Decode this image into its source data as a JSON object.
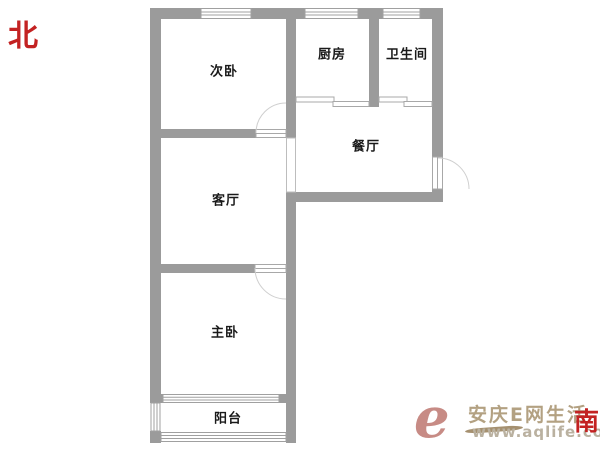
{
  "compass": {
    "north": "北",
    "south": "南",
    "color": "#c32222"
  },
  "rooms": [
    {
      "name": "次卧"
    },
    {
      "name": "厨房"
    },
    {
      "name": "卫生间"
    },
    {
      "name": "餐厅"
    },
    {
      "name": "客厅"
    },
    {
      "name": "主卧"
    },
    {
      "name": "阳台"
    }
  ],
  "watermark": {
    "logo": "e",
    "site_name": "安庆E网生活",
    "url": "www.aqlife.com",
    "logo_color": "#c78b85",
    "site_name_color": "#b3a182",
    "url_color": "#bab1a0"
  },
  "colors": {
    "wall": "#9b9b9b",
    "window_outline": "#a0a0a0",
    "door_outline": "#a8a8a8",
    "arc": "#cfcfcf",
    "room_label": "#1a1a1a",
    "background": "#ffffff"
  }
}
